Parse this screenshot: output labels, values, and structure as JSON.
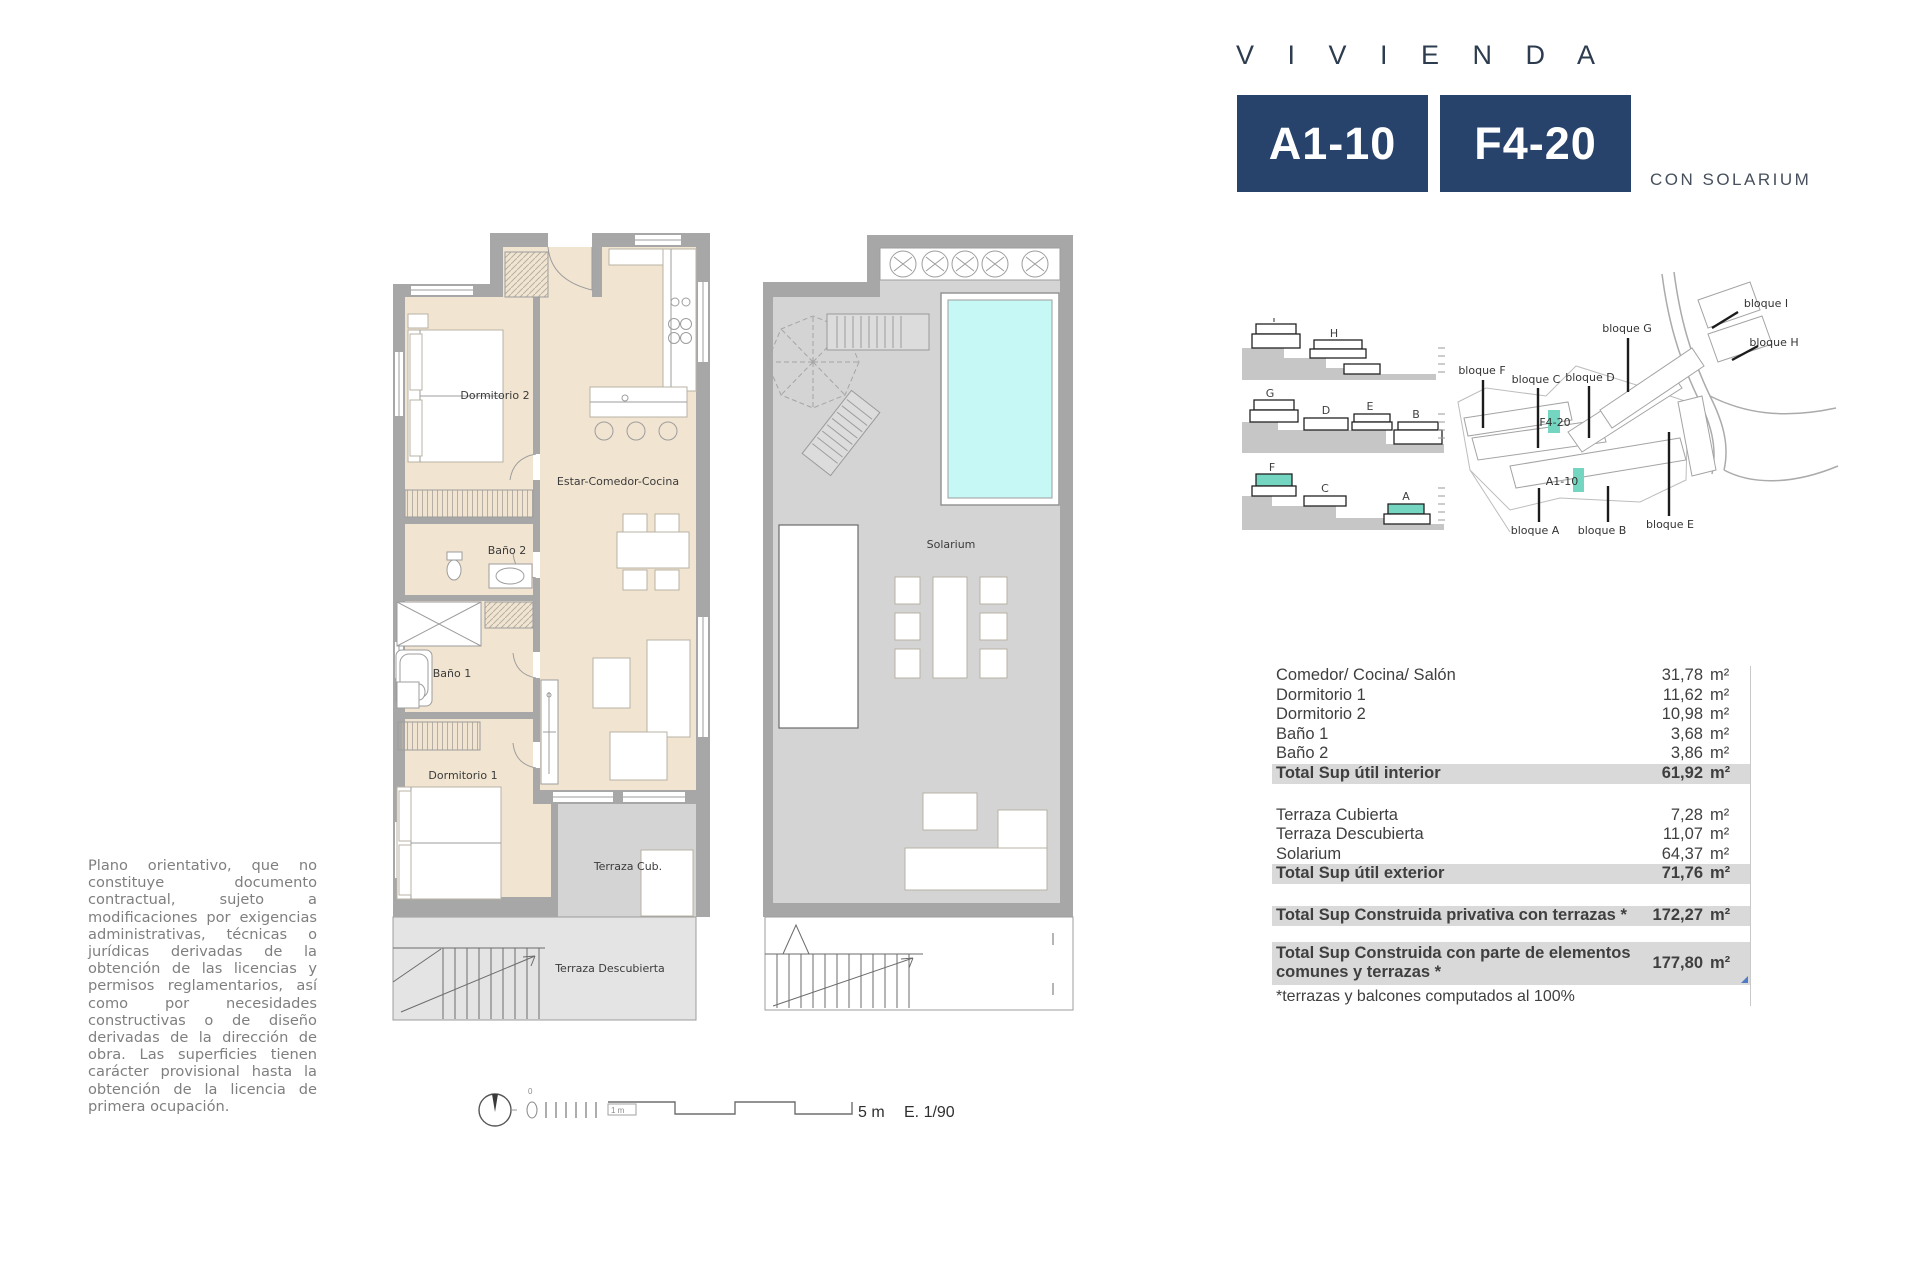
{
  "header": {
    "title": "V I V I E N D A",
    "unit_primary": "A1-10",
    "unit_secondary": "F4-20",
    "subtitle": "CON SOLARIUM"
  },
  "colors": {
    "navy": "#27426b",
    "room_fill": "#f1e4d0",
    "wall_gray": "#a7a7a7",
    "terrace_gray": "#d4d4d4",
    "pool_cyan": "#c6f8f6",
    "highlight_teal": "#74d6c0",
    "total_row_bg": "#d9d9d9",
    "text_gray": "#7f7f7f"
  },
  "apartment_plan": {
    "labels": {
      "dormitorio2": "Dormitorio 2",
      "estar": "Estar-Comedor-Cocina",
      "bano2": "Baño 2",
      "bano1": "Baño 1",
      "dormitorio1": "Dormitorio 1",
      "terraza_cub": "Terraza Cub.",
      "terraza_desc": "Terraza Descubierta"
    }
  },
  "solarium_plan": {
    "labels": {
      "solarium": "Solarium"
    }
  },
  "sections_diagram": {
    "row1": [
      "I",
      "H"
    ],
    "row2": [
      "G",
      "D",
      "E",
      "B"
    ],
    "row3": [
      "F",
      "C",
      "A"
    ],
    "highlighted": [
      "F",
      "A"
    ]
  },
  "site_map": {
    "blocks": [
      "bloque F",
      "bloque C",
      "bloque G",
      "bloque D",
      "bloque I",
      "bloque H",
      "bloque A",
      "bloque B",
      "bloque E"
    ],
    "unit_labels": [
      "F4-20",
      "A1-10"
    ]
  },
  "scale_bar": {
    "zero_label": "0",
    "one_meter": "1 m",
    "five_meters": "5 m",
    "scale": "E. 1/90"
  },
  "disclaimer": "Plano orientativo, que no constituye documento contractual, sujeto a modificaciones por exigencias administrativas, técnicas o jurídicas derivadas de la obtención de las licencias y permisos reglamentarios, así como por necesidades constructivas o de diseño derivadas de la dirección de obra. Las superficies tienen carácter provisional hasta la obtención de la licencia de primera ocupación.",
  "areas_table": {
    "unit": "m²",
    "interior": [
      {
        "label": "Comedor/ Cocina/ Salón",
        "value": "31,78"
      },
      {
        "label": "Dormitorio 1",
        "value": "11,62"
      },
      {
        "label": "Dormitorio 2",
        "value": "10,98"
      },
      {
        "label": "Baño 1",
        "value": "3,68"
      },
      {
        "label": "Baño 2",
        "value": "3,86"
      }
    ],
    "interior_total": {
      "label": "Total Sup útil interior",
      "value": "61,92"
    },
    "exterior": [
      {
        "label": "Terraza Cubierta",
        "value": "7,28"
      },
      {
        "label": "Terraza Descubierta",
        "value": "11,07"
      },
      {
        "label": "Solarium",
        "value": "64,37"
      }
    ],
    "exterior_total": {
      "label": "Total Sup útil exterior",
      "value": "71,76"
    },
    "built_private": {
      "label": "Total Sup Construida privativa con terrazas *",
      "value": "172,27"
    },
    "built_common": {
      "label": "Total Sup Construida con parte de elementos comunes y terrazas *",
      "value": "177,80"
    },
    "footnote": "*terrazas y balcones computados al 100%"
  }
}
